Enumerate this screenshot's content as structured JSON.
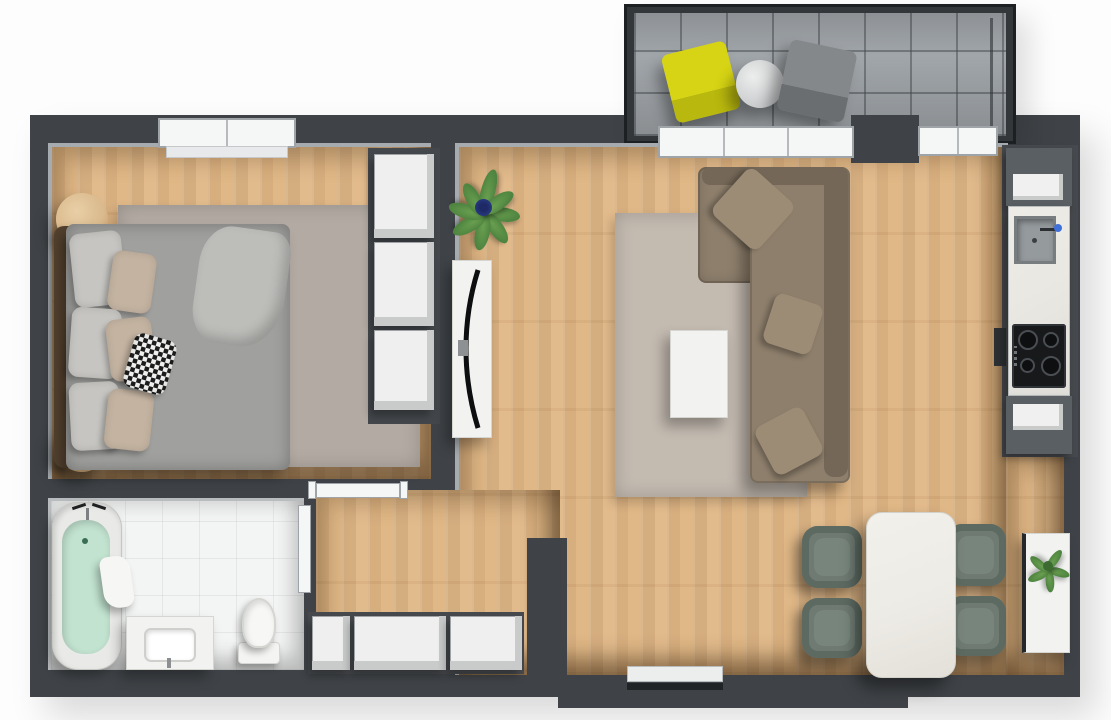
{
  "meta": {
    "title": "Apartment floor plan – 3D top-down render",
    "view": "top-down",
    "style": "3d-render",
    "visible_text": "none"
  },
  "colors": {
    "wall": "#3f4347",
    "wall_dark": "#33373a",
    "wall_edge": "#1d2023",
    "wood": "#e2bb8c",
    "tile_balcony": "#a4a9ad",
    "bath_floor": "#f3f4f4",
    "rug_bedroom": "#b3aba3",
    "rug_living": "#c3bab0",
    "bed_duvet": "#a0a09e",
    "pillow_gray": "#c6c5c1",
    "pillow_beige": "#c4b3a1",
    "headboard": "#54422f",
    "stool_wood": "#d9b88c",
    "wardrobe_face": "#eeefee",
    "wardrobe_side": "#c9cbca",
    "sofa": "#8e7f6c",
    "sofa_dark": "#746757",
    "sofa_pillow": "#9d8c75",
    "white_furniture": "#f2f2f0",
    "marble": "#edebe5",
    "dining_chair": "#6e7a72",
    "dining_chair_dark": "#5d6a62",
    "cabinet_gray": "#5a5f63",
    "counter_marble": "#e9e7e1",
    "sink_gray": "#959a9d",
    "cooktop_black": "#17191b",
    "water_mint": "#c2e3d0",
    "chair_yellow": "#d6d414",
    "chair_yellow_dark": "#b9b80e",
    "chair_gray": "#85888b",
    "chair_gray_dark": "#6b6e71",
    "plant_green": "#4e8340",
    "plant_green_light": "#6aa050",
    "plant_blue": "#30418f",
    "door_white": "#f5f6f6",
    "frame_gray": "#9fa4a8"
  },
  "rooms": [
    {
      "id": "balcony",
      "furniture": [
        "yellow-chair",
        "round-bistro-table",
        "gray-chair"
      ],
      "floor": "gray-tile"
    },
    {
      "id": "bedroom",
      "furniture": [
        "double-bed",
        "six-pillows",
        "checkered-cushion",
        "area-rug",
        "round-stool-top",
        "round-stool-bottom",
        "wardrobe-3-sections"
      ],
      "floor": "wood",
      "openings": [
        "window-top"
      ]
    },
    {
      "id": "living-room",
      "furniture": [
        "corner-sofa",
        "three-sofa-cushions",
        "area-rug",
        "coffee-table",
        "tv-board",
        "tv",
        "potted-plant",
        "dining-table",
        "dining-chairs",
        "sideboard-with-plant"
      ],
      "floor": "wood",
      "openings": [
        "balcony-door",
        "balcony-window"
      ]
    },
    {
      "id": "kitchen-strip",
      "furniture": [
        "upper-cabinet",
        "counter",
        "sink",
        "faucet",
        "cooktop",
        "lower-cabinet"
      ],
      "floor": "wood"
    },
    {
      "id": "bathroom",
      "furniture": [
        "bathtub",
        "towel",
        "vanity-sink",
        "toilet"
      ],
      "floor": "white-tile",
      "openings": [
        "door-to-hallway"
      ]
    },
    {
      "id": "hallway",
      "furniture": [
        "built-in-closets"
      ],
      "floor": "wood",
      "openings": [
        "bedroom-door",
        "entrance-door"
      ]
    }
  ],
  "counts": {
    "balcony_chairs": 2,
    "dining_chairs": 4,
    "cooktop_burners": 4,
    "wardrobe_sections": 3,
    "closet_sections": 3,
    "bed_pillows": 7
  }
}
